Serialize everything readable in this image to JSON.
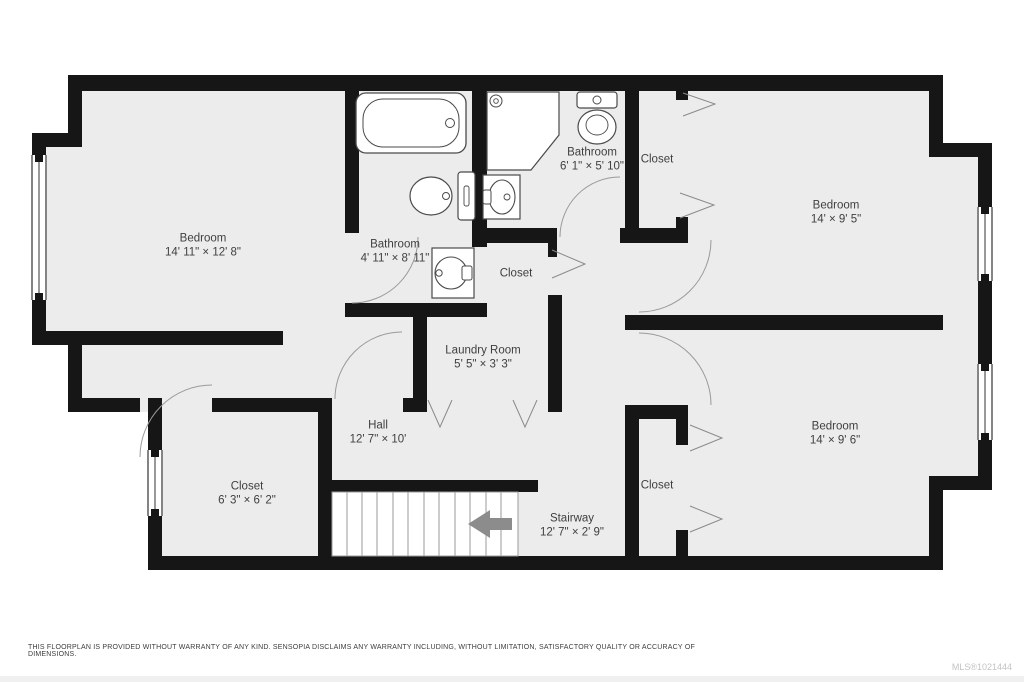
{
  "floorplan": {
    "rooms": [
      {
        "id": "bedroom-left",
        "name": "Bedroom",
        "dims": "14' 11\" × 12' 8\""
      },
      {
        "id": "bathroom-mid",
        "name": "Bathroom",
        "dims": "4' 11\" × 8' 11\""
      },
      {
        "id": "bathroom-top",
        "name": "Bathroom",
        "dims": "6' 1\" × 5' 10\""
      },
      {
        "id": "closet-top",
        "name": "Closet",
        "dims": ""
      },
      {
        "id": "bedroom-top-right",
        "name": "Bedroom",
        "dims": "14' × 9' 5\""
      },
      {
        "id": "closet-mid",
        "name": "Closet",
        "dims": ""
      },
      {
        "id": "laundry-room",
        "name": "Laundry Room",
        "dims": "5' 5\" × 3' 3\""
      },
      {
        "id": "hall",
        "name": "Hall",
        "dims": "12' 7\" × 10'"
      },
      {
        "id": "bedroom-bottom-right",
        "name": "Bedroom",
        "dims": "14' × 9' 6\""
      },
      {
        "id": "closet-bottom-right",
        "name": "Closet",
        "dims": ""
      },
      {
        "id": "closet-bottom-left",
        "name": "Closet",
        "dims": "6' 3\" × 6' 2\""
      },
      {
        "id": "stairway",
        "name": "Stairway",
        "dims": "12' 7\" × 2' 9\""
      }
    ],
    "icons": [
      "bathtub-icon",
      "toilet-icon",
      "sink-icon",
      "corner-shower-icon",
      "window-icon",
      "door-arc-icon",
      "door-chevron-icon",
      "stair-direction-arrow-icon"
    ],
    "colors": {
      "wall": "#161616",
      "floor": "#ececec",
      "fixture_stroke": "#4a4a4a",
      "door_arc": "#9a9a9a",
      "stair_arrow": "#8c8c8c",
      "label_text": "#3f3f3f",
      "mls_text": "#c3c3c3"
    }
  },
  "footer": {
    "disclaimer": "THIS FLOORPLAN IS PROVIDED WITHOUT WARRANTY OF ANY KIND. SENSOPIA DISCLAIMS ANY WARRANTY INCLUDING, WITHOUT LIMITATION, SATISFACTORY QUALITY OR ACCURACY OF DIMENSIONS.",
    "mls": "MLS®1021444"
  }
}
